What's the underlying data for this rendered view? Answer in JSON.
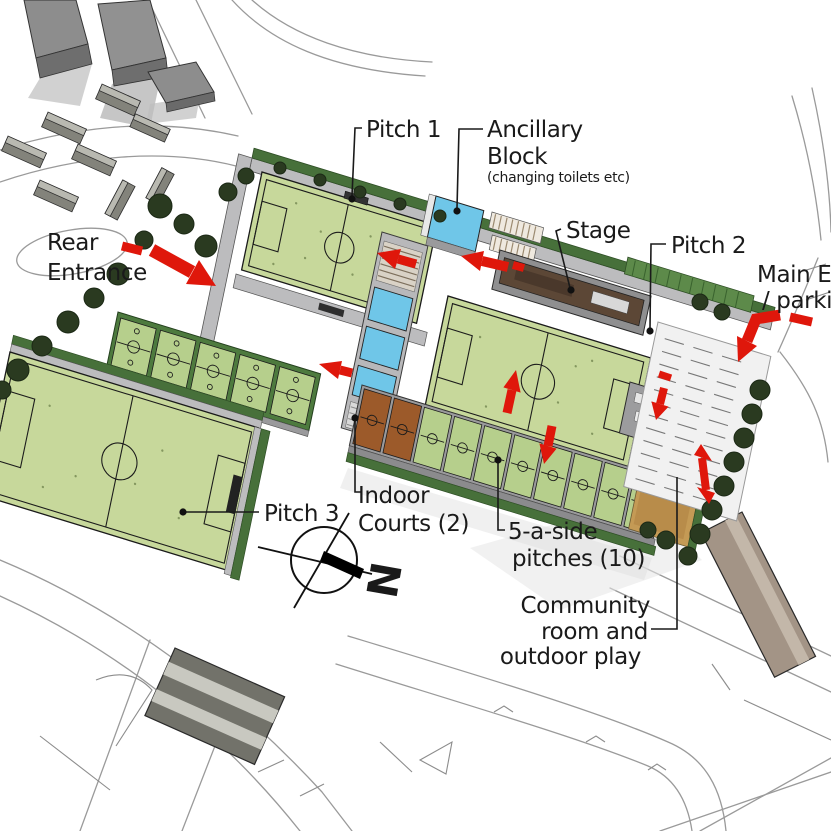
{
  "labels": {
    "pitch1": "Pitch 1",
    "ancillary_line1": "Ancillary",
    "ancillary_line2": "Block",
    "ancillary_note": "(changing toilets etc)",
    "stage": "Stage",
    "pitch2": "Pitch 2",
    "main_entrance_line1": "Main En",
    "main_entrance_line2": "/ parkin",
    "rear_line1": "Rear",
    "rear_line2": "Entrance",
    "pitch3": "Pitch 3",
    "indoor_line1": "Indoor",
    "indoor_line2": "Courts (2)",
    "five_line1": "5-a-side",
    "five_line2": "pitches (10)",
    "community_line1": "Community",
    "community_line2": "room and",
    "community_line3": "outdoor play",
    "compass_north": "N"
  },
  "colors": {
    "arrow_red": "#df170b",
    "pitch_green": "#c7d89b",
    "court_green": "#b6cf8c",
    "hedge_dark_green": "#47703a",
    "tree_dark": "#2a3a20",
    "roof_blue": "#6fc6e8",
    "stage_brown": "#5c4736",
    "court_brown": "#9c5a2a",
    "community_tan": "#c49a55",
    "path_grey": "#bcbcbe",
    "building_grey": "#8d8d8d"
  }
}
